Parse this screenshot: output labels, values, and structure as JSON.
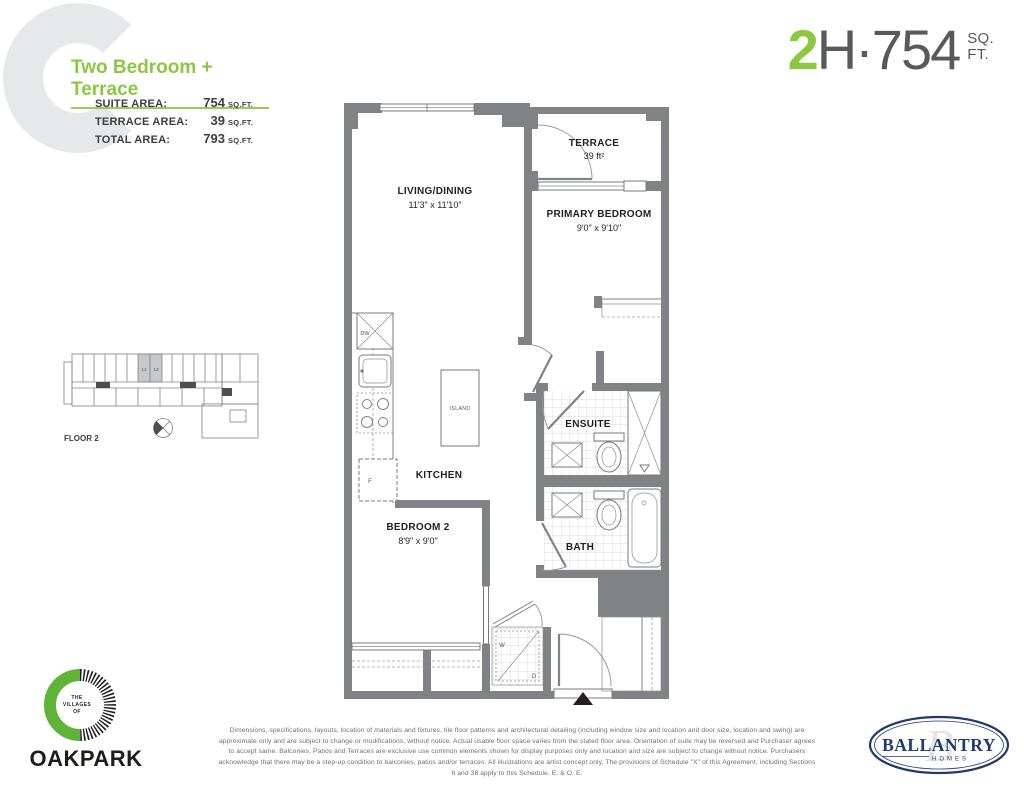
{
  "colors": {
    "accent_green": "#8dc63f",
    "wall_gray": "#808285",
    "text_gray": "#58595b",
    "navy": "#1f3a6d",
    "light_gray": "#e6e7e8"
  },
  "header": {
    "plan_name": "Two Bedroom + Terrace",
    "suite_rows": [
      {
        "label": "SUITE AREA:",
        "value": "754",
        "unit": "SQ.FT."
      },
      {
        "label": "TERRACE AREA:",
        "value": "39",
        "unit": "SQ.FT."
      },
      {
        "label": "TOTAL AREA:",
        "value": "793",
        "unit": "SQ.FT."
      }
    ],
    "unit_plate": {
      "number": "2",
      "code": "H·754",
      "sq": "SQ.",
      "ft": "FT."
    }
  },
  "floorplan": {
    "rooms": {
      "living": {
        "name": "LIVING/DINING",
        "dims": "11'3\" x 11'10\""
      },
      "terrace": {
        "name": "TERRACE",
        "dims": "39 ft²"
      },
      "primary": {
        "name": "PRIMARY BEDROOM",
        "dims": "9'0\" x 9'10\""
      },
      "bedroom2": {
        "name": "BEDROOM 2",
        "dims": "8'9\" x 9'0\""
      },
      "kitchen": {
        "name": "KITCHEN"
      },
      "island": {
        "name": "ISLAND"
      },
      "ensuite": {
        "name": "ENSUITE"
      },
      "bath": {
        "name": "BATH"
      }
    },
    "appliances": {
      "dishwasher": "DW",
      "fridge": "F",
      "washer": "W",
      "dryer": "D"
    }
  },
  "keyplan": {
    "floor_label": "FLOOR 2",
    "highlighted_units": [
      "12",
      "13"
    ]
  },
  "footer": {
    "disclaimer": "Dimensions, specifications, layouts, location of materials and fixtures, tile floor patterns and architectural detailing (including window size and location and door size, location and swing) are approximate only and are subject to change or modifications, without notice. Actual usable floor space varies from the stated floor area. Orientation of suite may be reversed and Purchaser agrees to accept same. Balconies, Patios and Terraces are exclusive use common elements shown for display purposes only and location and size are subject to change without notice. Purchasers acknowledge that there may be a step-up condition to balconies, patios and/or terraces. All illustrations are artist concept only. The provisions of Schedule \"X\" of this Agreement, including Sections 6 and 38 apply to this Schedule. E. & O. E.",
    "oakpark": {
      "the": "THE",
      "villages": "VILLAGES",
      "of": "OF",
      "name": "OAKPARK"
    },
    "ballantry": {
      "monogram": "B",
      "name": "BALLANTRY",
      "homes": "HOMES"
    }
  }
}
